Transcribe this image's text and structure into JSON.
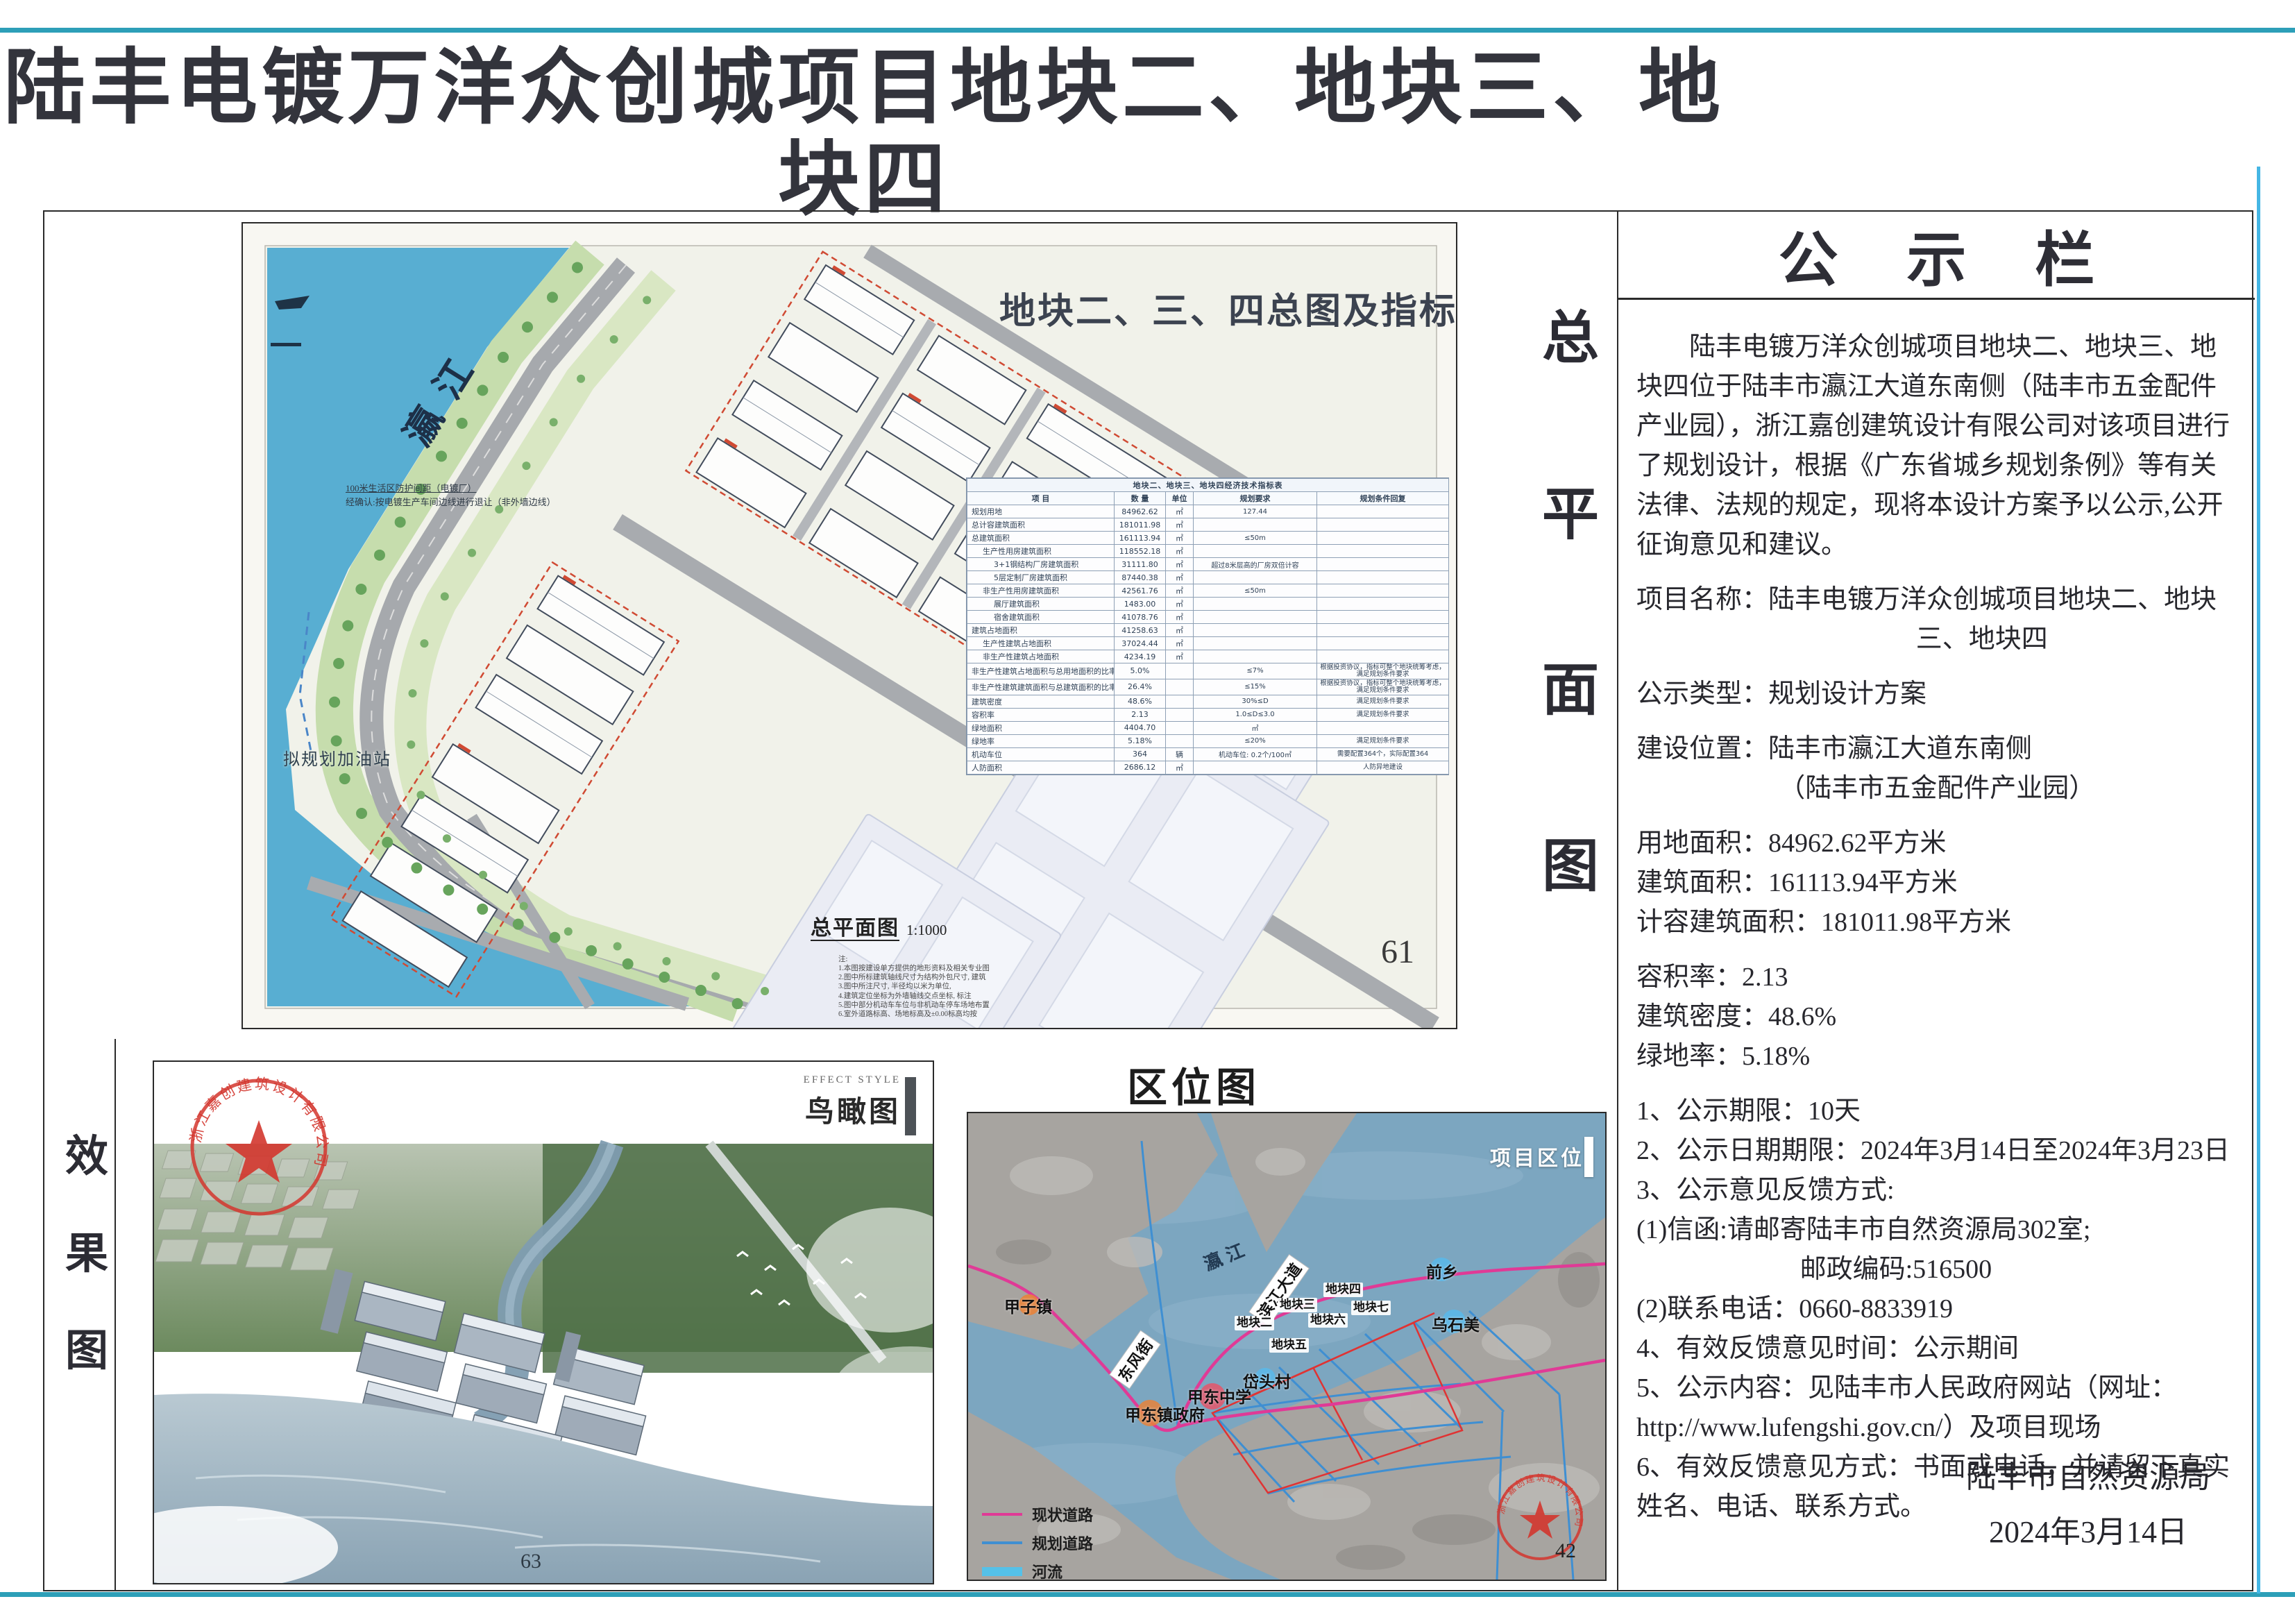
{
  "title": {
    "line1": "陆丰电镀万洋众创城项目地块二、地块三、地块四",
    "line2": "规划设计方案公示"
  },
  "stamps": {
    "company": "浙江嘉创建筑设计有限公司"
  },
  "site_plan": {
    "vertical_label": "总平面图",
    "map_title": "地块二、三、四总图及指标",
    "river_label": "瀛江",
    "note1": "100米生活区防护间距（电镀厂）",
    "note2": "经确认:按电镀生产车间边线进行退让（非外墙边线）",
    "gas_label": "拟规划加油站",
    "scale_label": "总平面图",
    "scale_value": "1:1000",
    "notes_title": "注:",
    "notes": [
      "1.本图按建设单方提供的地形资料及相关专业图",
      "2.图中所标建筑轴线尺寸为结构外包尺寸, 建筑",
      "3.图中所注尺寸, 半径均以米为单位,",
      "4.建筑定位坐标为外墙轴线交点坐标, 标注",
      "5.图中部分机动车车位与非机动车停车场地布置",
      "6.室外道路标高、场地标高及±0.00标高均按"
    ],
    "page_number": "61",
    "table": {
      "title": "地块二、地块三、地块四经济技术指标表",
      "headers": [
        "项  目",
        "数  量",
        "单位",
        "规划要求",
        "规划条件回复"
      ],
      "rows": [
        {
          "label": "规划用地",
          "qty": "84962.62",
          "unit": "㎡",
          "req": "127.44",
          "reply": "",
          "indent": 0
        },
        {
          "label": "总计容建筑面积",
          "qty": "181011.98",
          "unit": "㎡",
          "req": "",
          "reply": "",
          "indent": 0
        },
        {
          "label": "总建筑面积",
          "qty": "161113.94",
          "unit": "㎡",
          "req": "≤50m",
          "reply": "",
          "indent": 0
        },
        {
          "label": "生产性用房建筑面积",
          "qty": "118552.18",
          "unit": "㎡",
          "req": "",
          "reply": "",
          "indent": 1
        },
        {
          "label": "3+1钢结构厂房建筑面积",
          "qty": "31111.80",
          "unit": "㎡",
          "req": "超过8米层高的厂房双倍计容",
          "reply": "",
          "indent": 2
        },
        {
          "label": "5层定制厂房建筑面积",
          "qty": "87440.38",
          "unit": "㎡",
          "req": "",
          "reply": "",
          "indent": 2
        },
        {
          "label": "非生产性用房建筑面积",
          "qty": "42561.76",
          "unit": "㎡",
          "req": "≤50m",
          "reply": "",
          "indent": 1
        },
        {
          "label": "展厅建筑面积",
          "qty": "1483.00",
          "unit": "㎡",
          "req": "",
          "reply": "",
          "indent": 2
        },
        {
          "label": "宿舍建筑面积",
          "qty": "41078.76",
          "unit": "㎡",
          "req": "",
          "reply": "",
          "indent": 2
        },
        {
          "label": "建筑占地面积",
          "qty": "41258.63",
          "unit": "㎡",
          "req": "",
          "reply": "",
          "indent": 0
        },
        {
          "label": "生产性建筑占地面积",
          "qty": "37024.44",
          "unit": "㎡",
          "req": "",
          "reply": "",
          "indent": 1
        },
        {
          "label": "非生产性建筑占地面积",
          "qty": "4234.19",
          "unit": "㎡",
          "req": "",
          "reply": "",
          "indent": 1
        },
        {
          "label": "非生产性建筑占地面积与总用地面积的比率",
          "qty": "5.0%",
          "unit": "",
          "req": "≤7%",
          "reply": "根据投资协议，指标可整个地块统筹考虑，满足规划条件要求",
          "indent": 0
        },
        {
          "label": "非生产性建筑建筑面积与总建筑面积的比率",
          "qty": "26.4%",
          "unit": "",
          "req": "≤15%",
          "reply": "根据投资协议，指标可整个地块统筹考虑，满足规划条件要求",
          "indent": 0
        },
        {
          "label": "建筑密度",
          "qty": "48.6%",
          "unit": "",
          "req": "30%≤D",
          "reply": "满足规划条件要求",
          "indent": 0
        },
        {
          "label": "容积率",
          "qty": "2.13",
          "unit": "",
          "req": "1.0≤D≤3.0",
          "reply": "满足规划条件要求",
          "indent": 0
        },
        {
          "label": "绿地面积",
          "qty": "4404.70",
          "unit": "",
          "req": "㎡",
          "reply": "",
          "indent": 0
        },
        {
          "label": "绿地率",
          "qty": "5.18%",
          "unit": "",
          "req": "≤20%",
          "reply": "满足规划条件要求",
          "indent": 0
        },
        {
          "label": "机动车位",
          "qty": "364",
          "unit": "辆",
          "req": "机动车位: 0.2个/100㎡",
          "reply": "需要配置364个，实际配置364",
          "indent": 0
        },
        {
          "label": "人防面积",
          "qty": "2686.12",
          "unit": "㎡",
          "req": "",
          "reply": "人防异地建设",
          "indent": 0
        }
      ]
    }
  },
  "notice": {
    "heading": "公 示 栏",
    "lines": [
      {
        "t": "陆丰电镀万洋众创城项目地块二、地块三、地块四位于陆丰市瀛江大道东南侧（陆丰市五金配件产业园），浙江嘉创建筑设计有限公司对该项目进行了规划设计，根据《广东省城乡规划条例》等有关法律、法规的规定，现将本设计方案予以公示,公开征询意见和建议。",
        "c": "para"
      },
      {
        "t": "项目名称：陆丰电镀万洋众创城项目地块二、地块三、地块四",
        "c": "hang g"
      },
      {
        "t": "公示类型：规划设计方案",
        "c": "g"
      },
      {
        "t": "建设位置：陆丰市瀛江大道东南侧",
        "c": "g"
      },
      {
        "t": "（陆丰市五金配件产业园）",
        "c": "sub5"
      },
      {
        "t": "用地面积：84962.62平方米",
        "c": "g"
      },
      {
        "t": "建筑面积：161113.94平方米",
        "c": ""
      },
      {
        "t": "计容建筑面积：181011.98平方米",
        "c": ""
      },
      {
        "t": "容积率：2.13",
        "c": "g"
      },
      {
        "t": "建筑密度：48.6%",
        "c": ""
      },
      {
        "t": "绿地率：5.18%",
        "c": ""
      },
      {
        "t": "1、公示期限：10天",
        "c": "g"
      },
      {
        "t": "2、公示日期期限：2024年3月14日至2024年3月23日",
        "c": ""
      },
      {
        "t": "3、公示意见反馈方式:",
        "c": ""
      },
      {
        "t": "(1)信函:请邮寄陆丰市自然资源局302室;",
        "c": ""
      },
      {
        "t": "邮政编码:516500",
        "c": "sub6"
      },
      {
        "t": "(2)联系电话：0660-8833919",
        "c": ""
      },
      {
        "t": "4、有效反馈意见时间：公示期间",
        "c": ""
      },
      {
        "t": "5、公示内容：见陆丰市人民政府网站（网址：http://www.lufengshi.gov.cn/）及项目现场",
        "c": ""
      },
      {
        "t": "6、有效反馈意见方式：书面或电话，并请留下真实姓名、电话、联系方式。",
        "c": ""
      }
    ],
    "signoff": [
      "陆丰市自然资源局",
      "2024年3月14日"
    ]
  },
  "effect": {
    "strip_label": "效果图",
    "style_label": "EFFECT STYLE",
    "title": "鸟瞰图",
    "page_number": "63"
  },
  "location": {
    "title": "区位图",
    "corner_label": "项目区位",
    "river_label": "瀛江",
    "roads": [
      "滨江大道",
      "东风街"
    ],
    "plots": [
      "地块四",
      "地块七",
      "地块三",
      "地块二",
      "地块六",
      "地块五"
    ],
    "places": [
      {
        "name": "甲子镇",
        "color": "#e8833a"
      },
      {
        "name": "前乡",
        "color": "#5bb8e8"
      },
      {
        "name": "乌石美",
        "color": "#5bb8e8"
      },
      {
        "name": "岱头村",
        "color": "#5bb8e8"
      },
      {
        "name": "甲东中学",
        "color": "#e05a6e"
      },
      {
        "name": "甲东镇政府",
        "color": "#e8833a"
      }
    ],
    "legend": [
      {
        "label": "现状道路",
        "color": "#e03a96",
        "thick": 4
      },
      {
        "label": "规划道路",
        "color": "#3f8fd2",
        "thick": 4
      },
      {
        "label": "河流",
        "color": "#55c1e8",
        "thick": 13
      }
    ],
    "page_number": "42"
  }
}
